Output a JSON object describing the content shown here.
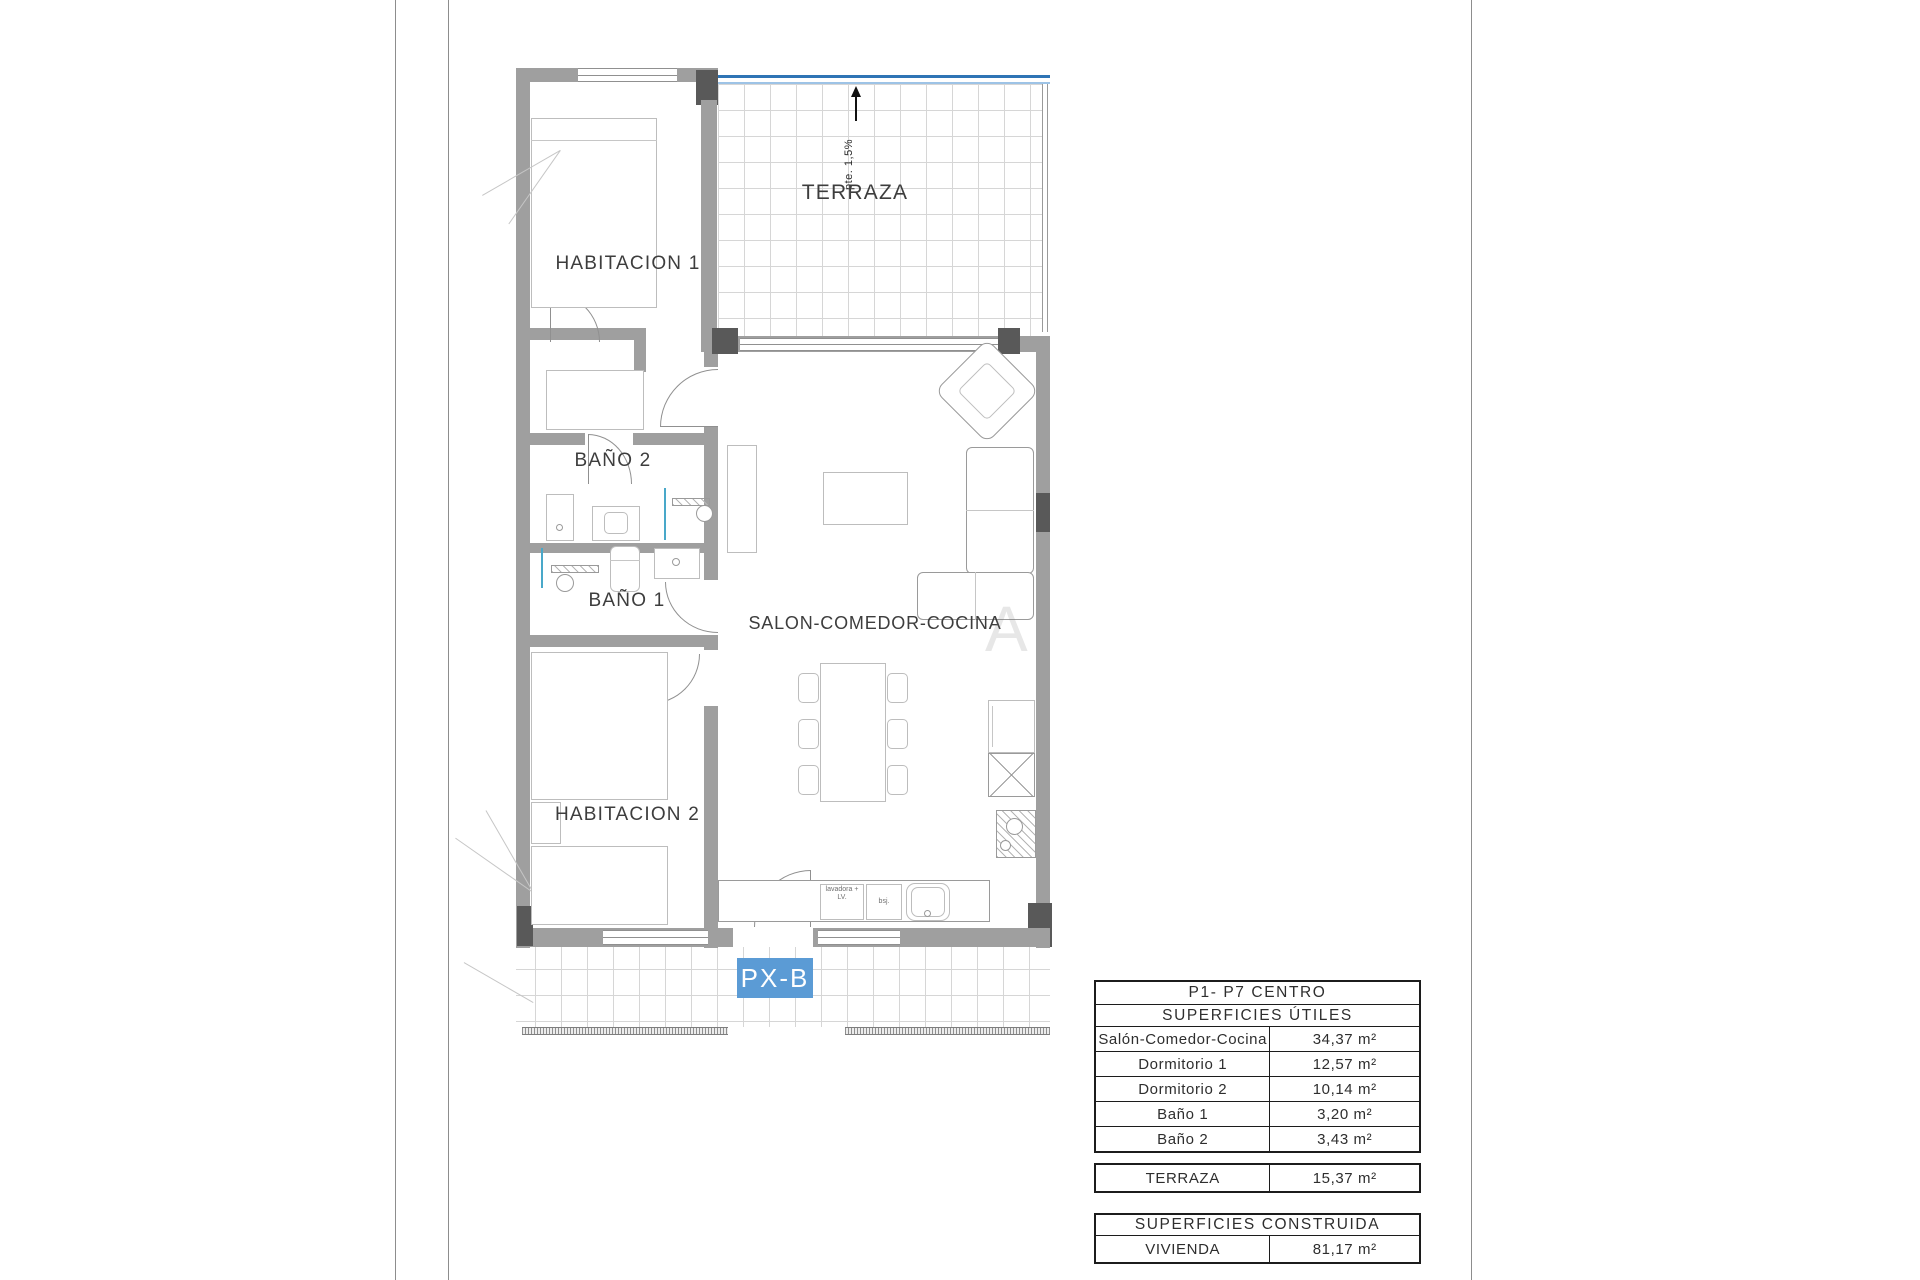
{
  "plan": {
    "labels": {
      "habitacion1": "HABITACION 1",
      "habitacion2": "HABITACION 2",
      "bano1": "BAÑO 1",
      "bano2": "BAÑO 2",
      "terraza": "TERRAZA",
      "salon": "SALON-COMEDOR-COCINA"
    },
    "slope_note": "pte. 1,5%",
    "unit_tag": "PX-B",
    "appliances": {
      "washer": "lavadora + LV.",
      "box": "bsj."
    },
    "watermark": "A",
    "colors": {
      "wall": "#9f9f9f",
      "wall_dark": "#595959",
      "tag_blue": "#5b9bd5",
      "terrace_blue": "#2e74b5",
      "screen_blue": "#49a8c9"
    }
  },
  "tables": {
    "utiles": {
      "title": "P1- P7 CENTRO",
      "subtitle": "SUPERFICIES ÚTILES",
      "rows": [
        {
          "name": "Salón-Comedor-Cocina",
          "value": "34,37 m²"
        },
        {
          "name": "Dormitorio 1",
          "value": "12,57 m²"
        },
        {
          "name": "Dormitorio 2",
          "value": "10,14 m²"
        },
        {
          "name": "Baño 1",
          "value": "3,20 m²"
        },
        {
          "name": "Baño 2",
          "value": "3,43 m²"
        }
      ]
    },
    "terraza": {
      "name": "TERRAZA",
      "value": "15,37 m²"
    },
    "construida": {
      "title": "SUPERFICIES CONSTRUIDA",
      "rows": [
        {
          "name": "VIVIENDA",
          "value": "81,17 m²"
        }
      ]
    }
  }
}
